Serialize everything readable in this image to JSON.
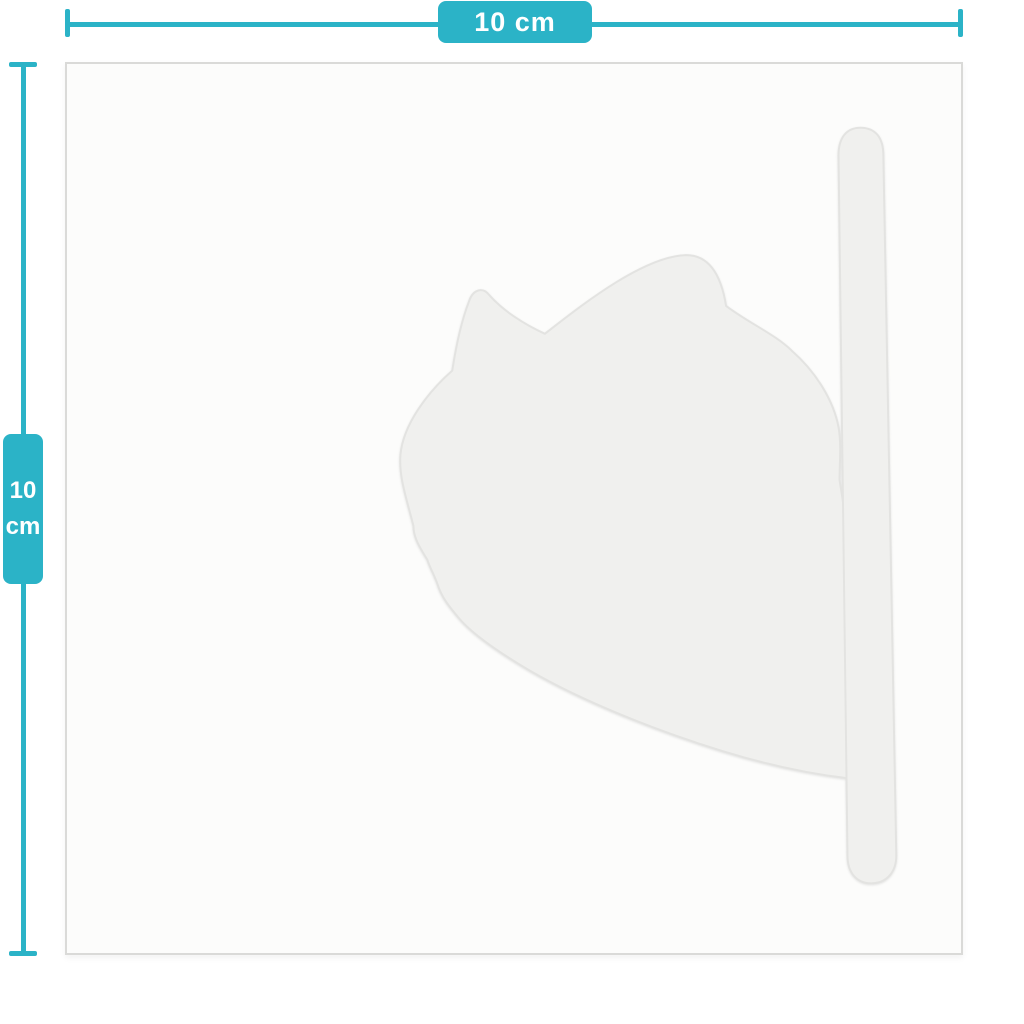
{
  "width_dimension": {
    "label": "10 cm"
  },
  "height_dimension": {
    "value": "10",
    "unit": "cm"
  },
  "sheet": {
    "shape": "square-backing-sheet"
  },
  "decal": {
    "shape": "cat-silhouette-with-tail"
  },
  "colors": {
    "accent_teal": "#2bb3c7",
    "label_text": "#ffffff",
    "page_bg": "#ffffff",
    "sheet_bg": "#fcfcfb",
    "sheet_border": "#dadad8",
    "decal_fill": "#f0f0ee",
    "decal_edge": "#e3e3e1"
  }
}
